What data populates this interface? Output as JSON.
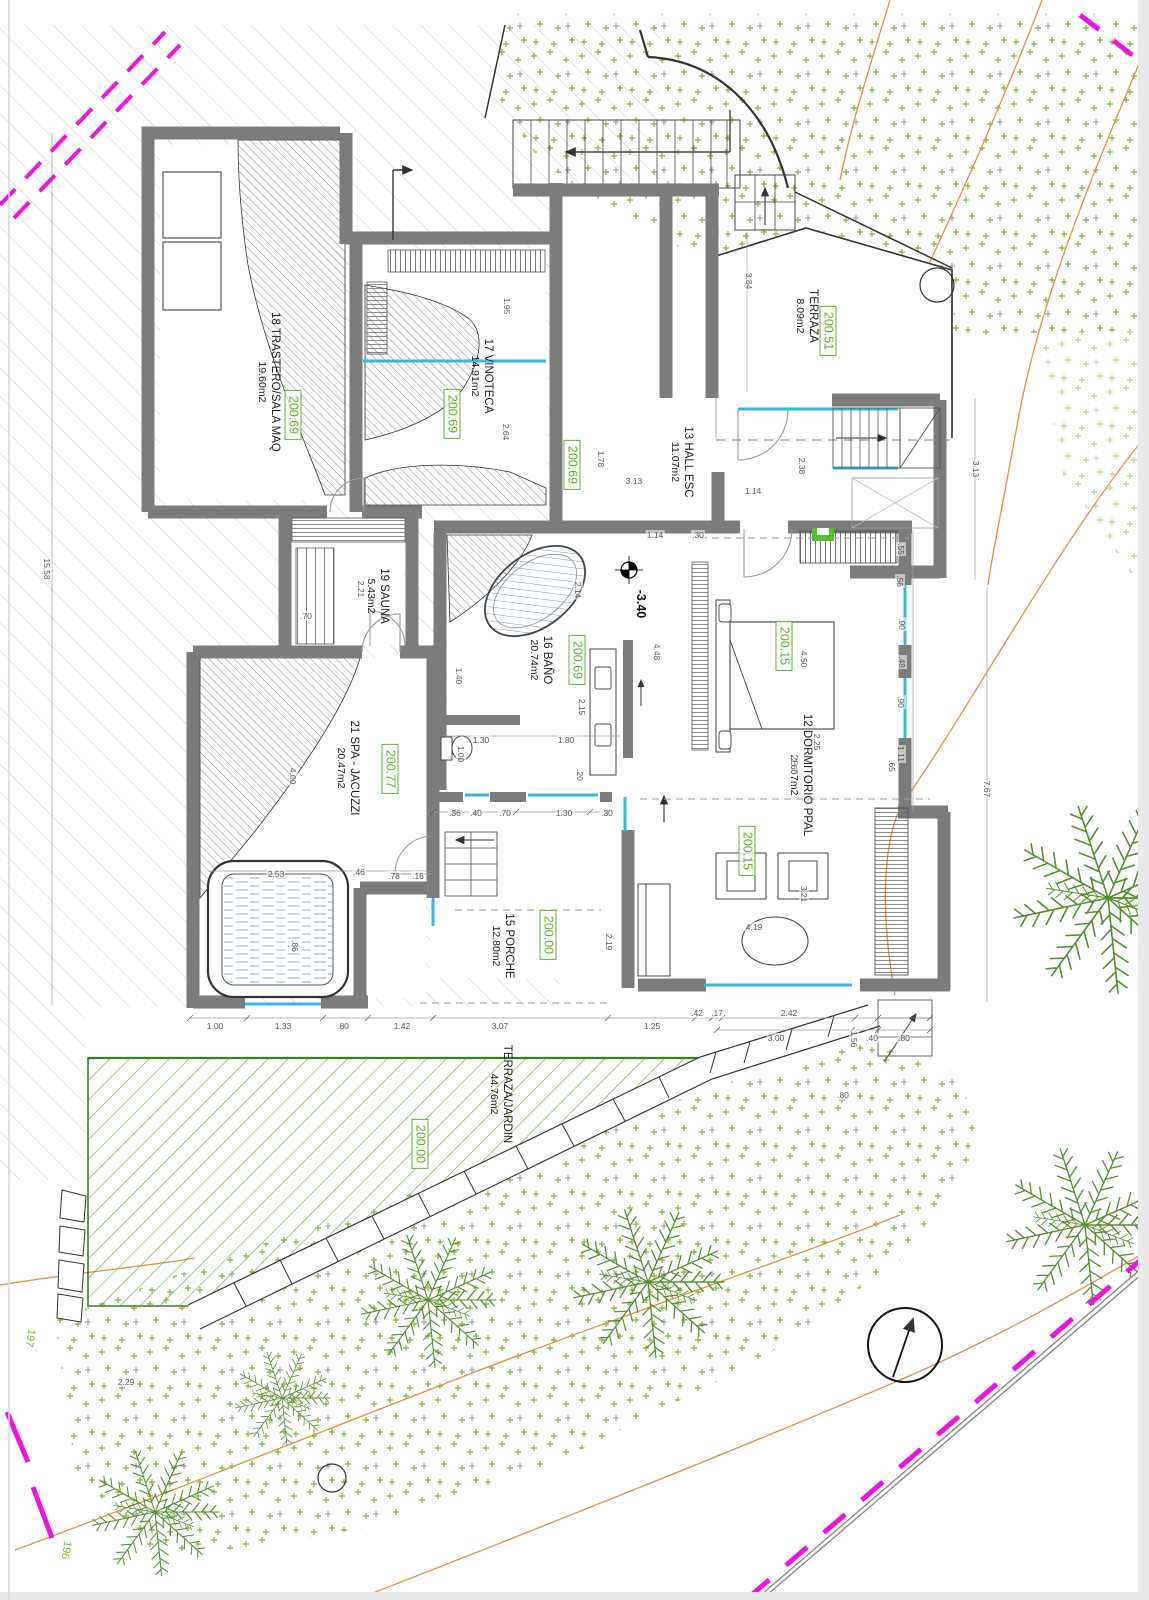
{
  "meta": {
    "drawing_type": "architectural floor plan",
    "level_note": "spa / bedroom level"
  },
  "colors": {
    "wall": "#7c7c7c",
    "glass": "#35b6e4",
    "elevation_green": "#5fb32c",
    "vegetation": "#7fb52a",
    "contour_orange": "#e0913d",
    "boundary_magenta": "#ee13e0",
    "jardin_green": "#64a438"
  },
  "rooms": [
    {
      "name": "18 TRASTERO/SALA MAQ",
      "area": "19.60m2",
      "x": 268,
      "y": 382
    },
    {
      "name": "17 VINOTECA",
      "area": "14.91m2",
      "x": 481,
      "y": 376
    },
    {
      "name": "13 HALL ESC",
      "area": "11.07m2",
      "x": 681,
      "y": 462
    },
    {
      "name": "TERRAZA",
      "area": "8.09m2",
      "x": 806,
      "y": 316
    },
    {
      "name": "19 SAUNA",
      "area": "5.43m2",
      "x": 377,
      "y": 596
    },
    {
      "name": "16 BAÑO",
      "area": "20.74m2",
      "x": 540,
      "y": 660
    },
    {
      "name": "12 DORMITORIO PPAL",
      "area": "28.57m2",
      "x": 800,
      "y": 775
    },
    {
      "name": "21 SPA - JACUZZI",
      "area": "20.47m2",
      "x": 347,
      "y": 768
    },
    {
      "name": "15 PORCHE",
      "area": "12.80m2",
      "x": 502,
      "y": 946
    },
    {
      "name": "TERRAZA/JARDIN",
      "area": "44.76m2",
      "x": 500,
      "y": 1094
    }
  ],
  "elevations": [
    {
      "value": "200.69",
      "x": 293,
      "y": 415
    },
    {
      "value": "200.69",
      "x": 452,
      "y": 414
    },
    {
      "value": "200.69",
      "x": 572,
      "y": 465
    },
    {
      "value": "200.51",
      "x": 828,
      "y": 331
    },
    {
      "value": "200.69",
      "x": 577,
      "y": 660
    },
    {
      "value": "200.15",
      "x": 784,
      "y": 646
    },
    {
      "value": "200.15",
      "x": 747,
      "y": 851
    },
    {
      "value": "200.77",
      "x": 390,
      "y": 769
    },
    {
      "value": "200.00",
      "x": 548,
      "y": 935
    },
    {
      "value": "200.00",
      "x": 420,
      "y": 1144
    }
  ],
  "level_marker": {
    "value": "-3.40"
  },
  "contour_labels": [
    {
      "value": "197",
      "x": 30,
      "y": 1338
    },
    {
      "value": "196",
      "x": 66,
      "y": 1550
    }
  ],
  "dimensions": [
    {
      "t": "1.00",
      "x": 215,
      "y": 1026,
      "r": 0
    },
    {
      "t": "1.33",
      "x": 283,
      "y": 1026,
      "r": 0
    },
    {
      "t": ".80",
      "x": 343,
      "y": 1026,
      "r": 0
    },
    {
      "t": "1.42",
      "x": 402,
      "y": 1026,
      "r": 0
    },
    {
      "t": "3.07",
      "x": 500,
      "y": 1026,
      "r": 0
    },
    {
      "t": "1.25",
      "x": 652,
      "y": 1026,
      "r": 0
    },
    {
      "t": ".42",
      "x": 697,
      "y": 1013,
      "r": 0
    },
    {
      "t": ".17",
      "x": 717,
      "y": 1013,
      "r": 0
    },
    {
      "t": "2.42",
      "x": 789,
      "y": 1013,
      "r": 0
    },
    {
      "t": "3.00",
      "x": 776,
      "y": 1038,
      "r": 0
    },
    {
      "t": ".40",
      "x": 872,
      "y": 1038,
      "r": 0
    },
    {
      "t": ".80",
      "x": 904,
      "y": 1038,
      "r": 0
    },
    {
      "t": ".36",
      "x": 455,
      "y": 813,
      "r": 0
    },
    {
      "t": ".40",
      "x": 476,
      "y": 813,
      "r": 0
    },
    {
      "t": ".70",
      "x": 505,
      "y": 813,
      "r": 0
    },
    {
      "t": "1.30",
      "x": 564,
      "y": 813,
      "r": 0
    },
    {
      "t": ".30",
      "x": 607,
      "y": 813,
      "r": 0
    },
    {
      "t": "1.30",
      "x": 481,
      "y": 740,
      "r": 0
    },
    {
      "t": "1.80",
      "x": 566,
      "y": 740,
      "r": 0
    },
    {
      "t": "1.40",
      "x": 459,
      "y": 676,
      "r": 90
    },
    {
      "t": "1.00",
      "x": 461,
      "y": 754,
      "r": 90
    },
    {
      "t": "2.15",
      "x": 582,
      "y": 707,
      "r": 90
    },
    {
      "t": "2.14",
      "x": 578,
      "y": 590,
      "r": 90
    },
    {
      "t": ".20",
      "x": 580,
      "y": 775,
      "r": 90
    },
    {
      "t": "4.48",
      "x": 657,
      "y": 652,
      "r": 90
    },
    {
      "t": "1.14",
      "x": 655,
      "y": 535,
      "r": 0
    },
    {
      "t": ".30",
      "x": 698,
      "y": 535,
      "r": 0
    },
    {
      "t": "3.13",
      "x": 634,
      "y": 481,
      "r": 0
    },
    {
      "t": "1.14",
      "x": 753,
      "y": 491,
      "r": 0
    },
    {
      "t": "1.78",
      "x": 601,
      "y": 459,
      "r": 90
    },
    {
      "t": "2.38",
      "x": 802,
      "y": 466,
      "r": 90
    },
    {
      "t": "1.95",
      "x": 507,
      "y": 306,
      "r": 90
    },
    {
      "t": "2.64",
      "x": 506,
      "y": 432,
      "r": 90
    },
    {
      "t": "3.84",
      "x": 749,
      "y": 281,
      "r": 90
    },
    {
      "t": "3.13",
      "x": 976,
      "y": 469,
      "r": 90
    },
    {
      "t": "7.67",
      "x": 987,
      "y": 789,
      "r": 90
    },
    {
      "t": "15.58",
      "x": 47,
      "y": 569,
      "r": 90
    },
    {
      "t": ".55",
      "x": 901,
      "y": 549,
      "r": 90
    },
    {
      "t": ".56",
      "x": 900,
      "y": 581,
      "r": 90
    },
    {
      "t": ".90",
      "x": 902,
      "y": 624,
      "r": 90
    },
    {
      "t": ".48",
      "x": 902,
      "y": 662,
      "r": 90
    },
    {
      "t": ".90",
      "x": 901,
      "y": 702,
      "r": 90
    },
    {
      "t": "1.11",
      "x": 901,
      "y": 754,
      "r": 90
    },
    {
      "t": ".65",
      "x": 892,
      "y": 766,
      "r": 90
    },
    {
      "t": "4.50",
      "x": 804,
      "y": 659,
      "r": 90
    },
    {
      "t": "2.60",
      "x": 794,
      "y": 766,
      "r": 90
    },
    {
      "t": "2.25",
      "x": 817,
      "y": 742,
      "r": 90
    },
    {
      "t": "3.21",
      "x": 804,
      "y": 894,
      "r": 90
    },
    {
      "t": "2.19",
      "x": 609,
      "y": 942,
      "r": 90
    },
    {
      "t": "4.19",
      "x": 754,
      "y": 927,
      "r": 0
    },
    {
      "t": "2.53",
      "x": 276,
      "y": 874,
      "r": 0
    },
    {
      "t": ".46",
      "x": 359,
      "y": 872,
      "r": 0
    },
    {
      "t": ".78",
      "x": 394,
      "y": 876,
      "r": 0
    },
    {
      "t": ".16",
      "x": 418,
      "y": 876,
      "r": 0
    },
    {
      "t": ".86",
      "x": 295,
      "y": 946,
      "r": 90
    },
    {
      "t": "4.00",
      "x": 293,
      "y": 776,
      "r": 90
    },
    {
      "t": "2.21",
      "x": 361,
      "y": 589,
      "r": 90
    },
    {
      "t": ".70",
      "x": 306,
      "y": 616,
      "r": 0
    },
    {
      "t": "2.29",
      "x": 126,
      "y": 1382,
      "r": 0
    },
    {
      "t": ".80",
      "x": 843,
      "y": 1095,
      "r": 0
    },
    {
      "t": "1.56",
      "x": 854,
      "y": 1039,
      "r": 90
    }
  ]
}
